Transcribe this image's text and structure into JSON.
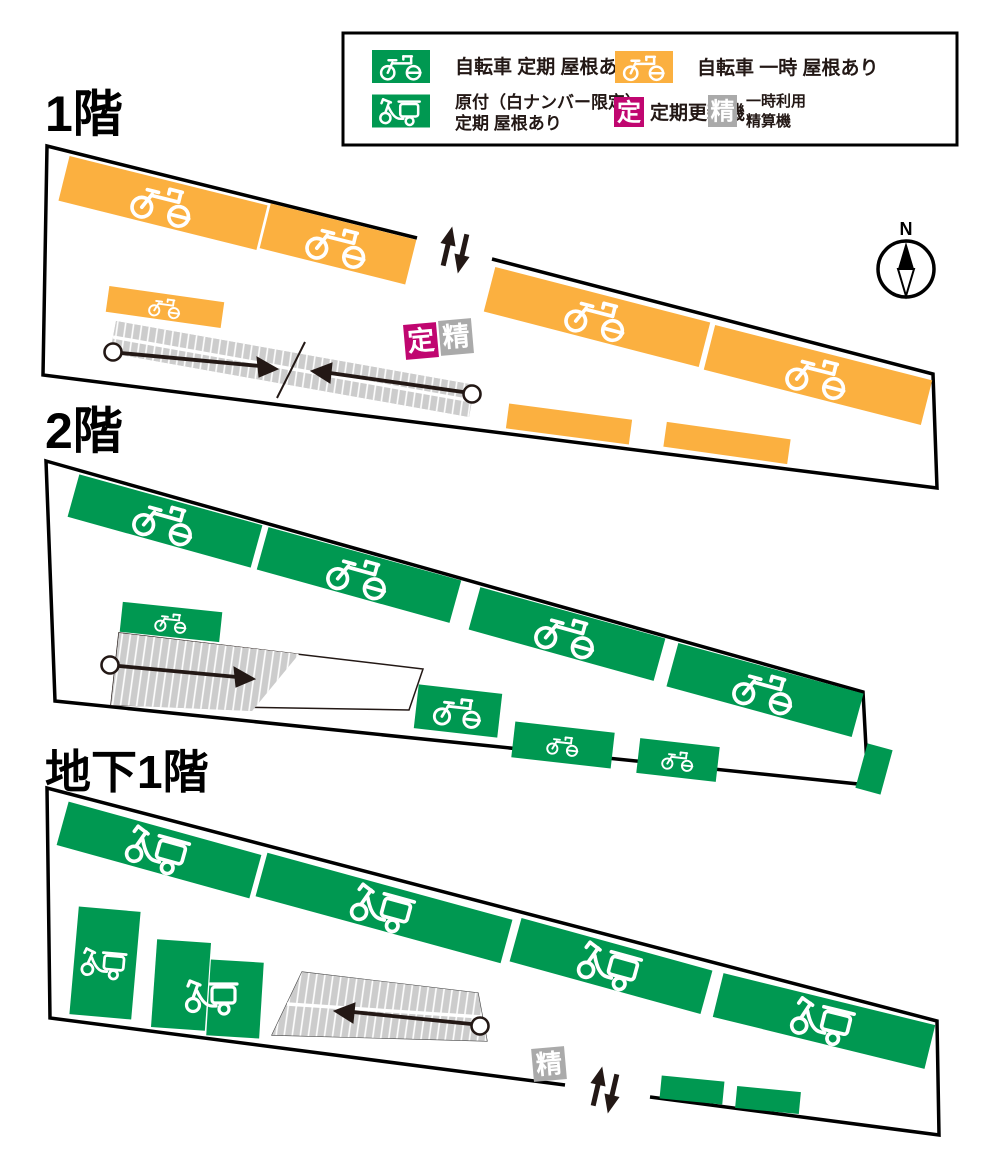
{
  "colors": {
    "green": "#009851",
    "orange": "#FBB040",
    "magenta": "#C00670",
    "gray_box": "#AAAAAA",
    "ramp_gray": "#CCCCCC",
    "ink": "#231815"
  },
  "legend": {
    "items": [
      {
        "id": "bicycle-regular",
        "label": "自転車 定期 屋根あり"
      },
      {
        "id": "bicycle-temporary",
        "label": "自転車 一時 屋根あり"
      },
      {
        "id": "moped-regular",
        "label_line1": "原付（白ナンバー限定）",
        "label_line2": "定期 屋根あり"
      },
      {
        "id": "renewal-machine",
        "symbol": "定",
        "label": "定期更新機"
      },
      {
        "id": "payment-machine",
        "symbol": "精",
        "label_line1": "一時利用",
        "label_line2": "精算機"
      }
    ]
  },
  "floors": [
    {
      "id": "floor-1",
      "title": "1階"
    },
    {
      "id": "floor-2",
      "title": "2階"
    },
    {
      "id": "basement-1",
      "title": "地下1階"
    }
  ],
  "machines": {
    "renewal_symbol": "定",
    "payment_symbol": "精"
  },
  "compass": {
    "north_label": "N"
  }
}
